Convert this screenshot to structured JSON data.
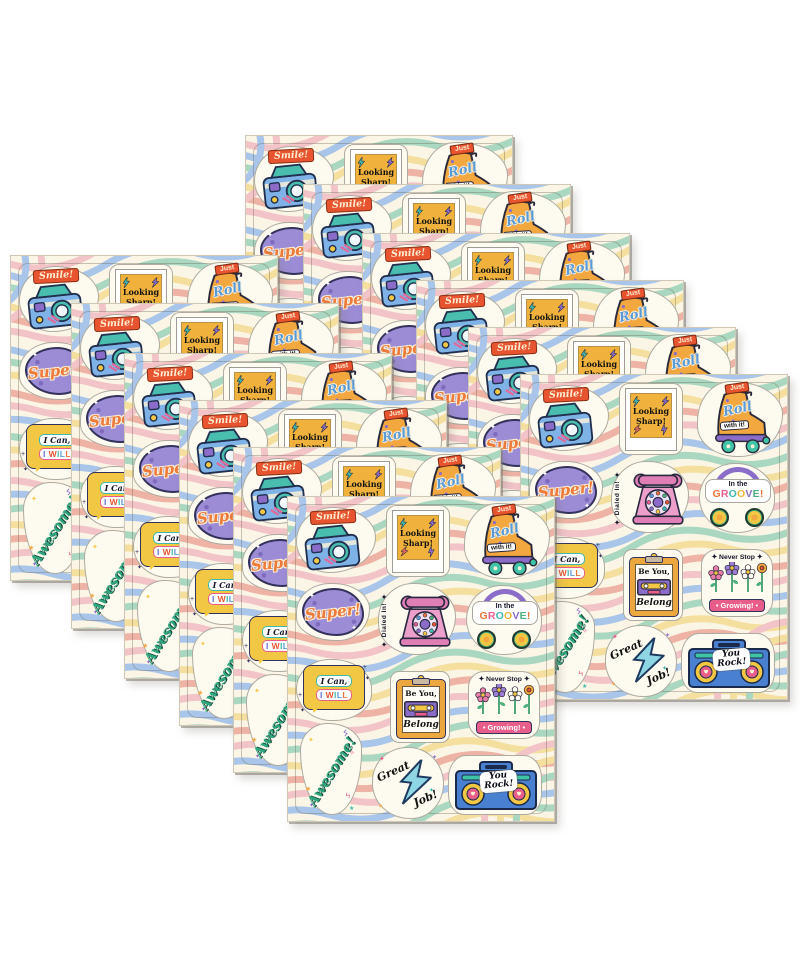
{
  "product": {
    "description": "Pack of retro-style motivational sticker sheets fanned out on a white background",
    "sheet_count": 12,
    "stickers_per_sheet": 12,
    "grid": {
      "rows": 4,
      "columns": 3
    }
  },
  "colors": {
    "palette": {
      "orange": "#E8542F",
      "amber": "#F2A73F",
      "yellow": "#F2C744",
      "gold": "#F0B23C",
      "teal": "#3FB8AF",
      "mint": "#3FC4A8",
      "green": "#4CAF7D",
      "blue": "#5B9BD5",
      "skyblue": "#7FB3E8",
      "iceblue": "#8FD6E4",
      "purple": "#8B6CC9",
      "lilac": "#9C8CD6",
      "pink": "#E85D8A",
      "rosepink": "#E891C4",
      "coral": "#E86A5E",
      "ink": "#26263B",
      "cream": "#FBF5E6",
      "cream2": "#FDFAF0",
      "scriptteal": "#2FA67E"
    },
    "waves": [
      "#F2C4C8",
      "#A9C6EA",
      "#A9D7BF",
      "#F5DF9E",
      "#EFB3A6"
    ],
    "rainbow": [
      "#E8763A",
      "#E85D8A",
      "#3FB8AF",
      "#F2B33C",
      "#8B6CC9",
      "#4CAF7D",
      "#E8763A"
    ],
    "iwill": [
      "#6B6CD0",
      "#E8542F",
      "#3FB8AF",
      "#5B9BD5",
      "#E8763A",
      "#E85D8A"
    ]
  },
  "stickers": [
    {
      "id": "smile",
      "icon": "polaroid-camera",
      "label": "Smile!"
    },
    {
      "id": "looking-sharp",
      "icon": "photo-frame-lightning-bolts",
      "line1": "Looking",
      "line2": "Sharp!"
    },
    {
      "id": "just-roll",
      "icon": "roller-skate",
      "banner": "Just",
      "script": "Roll",
      "tag": "with it!"
    },
    {
      "id": "super",
      "icon": "purple-splat",
      "label": "Super!"
    },
    {
      "id": "dialed-in",
      "icon": "rotary-phone",
      "label": "✦ Dialed In! ✦"
    },
    {
      "id": "groove",
      "icon": "headphones",
      "line1": "In the",
      "line2": "GROOVE!"
    },
    {
      "id": "i-can-i-will",
      "icon": "speech-bubble",
      "line1": "I Can,",
      "line2": "I WILL"
    },
    {
      "id": "be-you-belong",
      "icon": "clipboard-cassette",
      "line1": "Be You,",
      "line2": "Belong"
    },
    {
      "id": "never-stop-growing",
      "icon": "flowers",
      "line1": "✦ Never Stop ✦",
      "line2": "• Growing! •"
    },
    {
      "id": "awesome",
      "icon": "sparkles-stars",
      "label": "Awesome!"
    },
    {
      "id": "great-job",
      "icon": "lightning-bolt-cloud",
      "word1": "Great",
      "word2": "Job!"
    },
    {
      "id": "you-rock",
      "icon": "boombox",
      "line1": "You",
      "line2": "Rock!"
    }
  ]
}
